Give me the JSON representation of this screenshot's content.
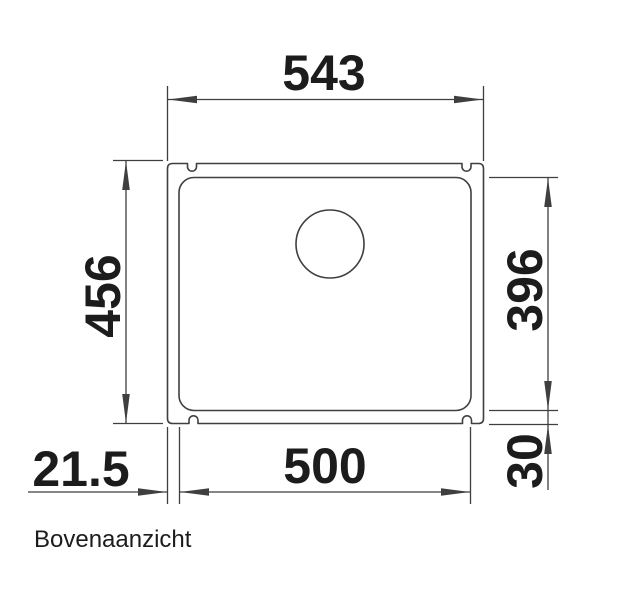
{
  "caption": "Bovenaanzicht",
  "drawing": {
    "dims": {
      "outer_width": "543",
      "outer_depth": "456",
      "bowl_depth": "396",
      "bowl_width": "500",
      "side_rim": "21.5",
      "bottom_rim": "30"
    },
    "colors": {
      "line": "#3f3f3f",
      "text": "#1c1c1c",
      "background": "#ffffff"
    }
  }
}
